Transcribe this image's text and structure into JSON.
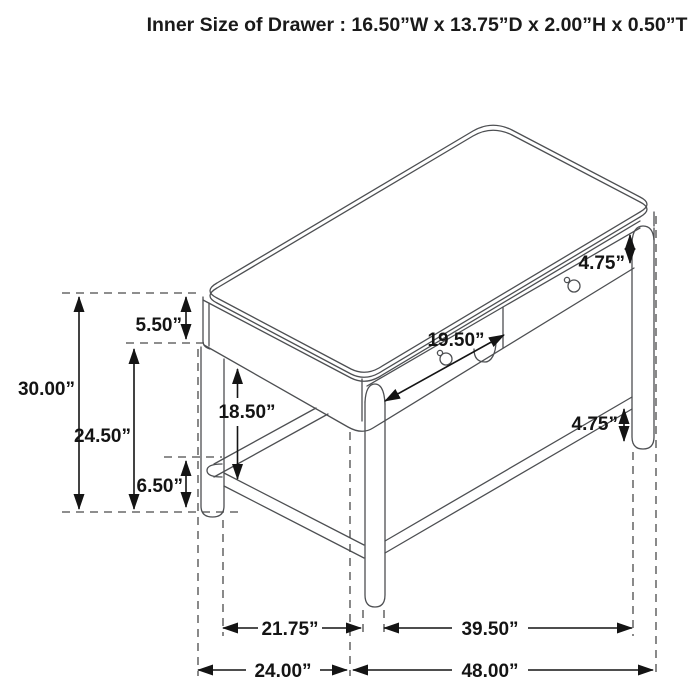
{
  "title": "Inner Size of Drawer : 16.50”W x 13.75”D x 2.00”H x 0.50”T",
  "dimensions": {
    "drawer_front_height": "4.75”",
    "drawer_opening_width": "19.50”",
    "top_to_apron_bottom": "5.50”",
    "overall_height": "30.00”",
    "floor_to_apron_bottom": "24.50”",
    "knee_clearance": "18.50”",
    "floor_to_stretcher": "6.50”",
    "stretcher_to_leg_bottom": "4.75”",
    "left_leg_to_center_leg_span": "21.75”",
    "center_leg_to_right_leg_span": "39.50”",
    "overall_depth": "24.00”",
    "overall_width": "48.00”"
  },
  "colors": {
    "line_art": "#4d4f52",
    "dimension_ink": "#141414",
    "background": "#ffffff"
  }
}
